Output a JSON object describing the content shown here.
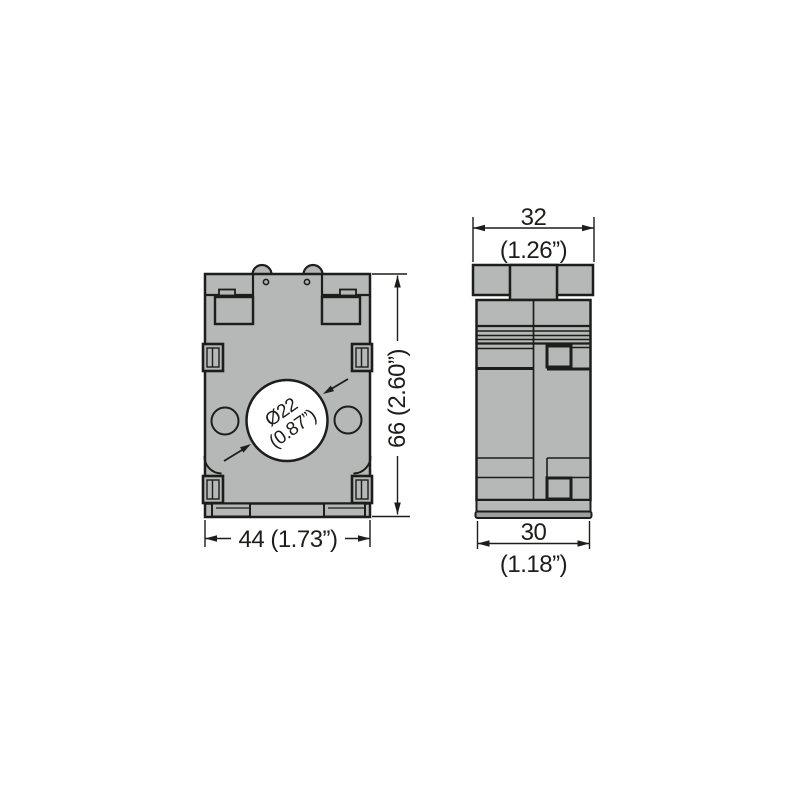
{
  "drawing": {
    "type": "dimensional-drawing",
    "views": {
      "front": {
        "width_dim": "44 (1.73”)",
        "height_dim": "66 (2.60”)",
        "bore_dim_line1": "Ø22",
        "bore_dim_line2": "(0.87”)"
      },
      "side": {
        "top_width_mm": "32",
        "top_width_in": "(1.26”)",
        "bottom_width_mm": "30",
        "bottom_width_in": "(1.18”)"
      }
    },
    "colors": {
      "body_fill": "#b5b8b7",
      "base_strip_fill": "#9ba09f",
      "line": "#1d1d1b",
      "bore_fill": "#ffffff",
      "background": "#ffffff"
    }
  }
}
